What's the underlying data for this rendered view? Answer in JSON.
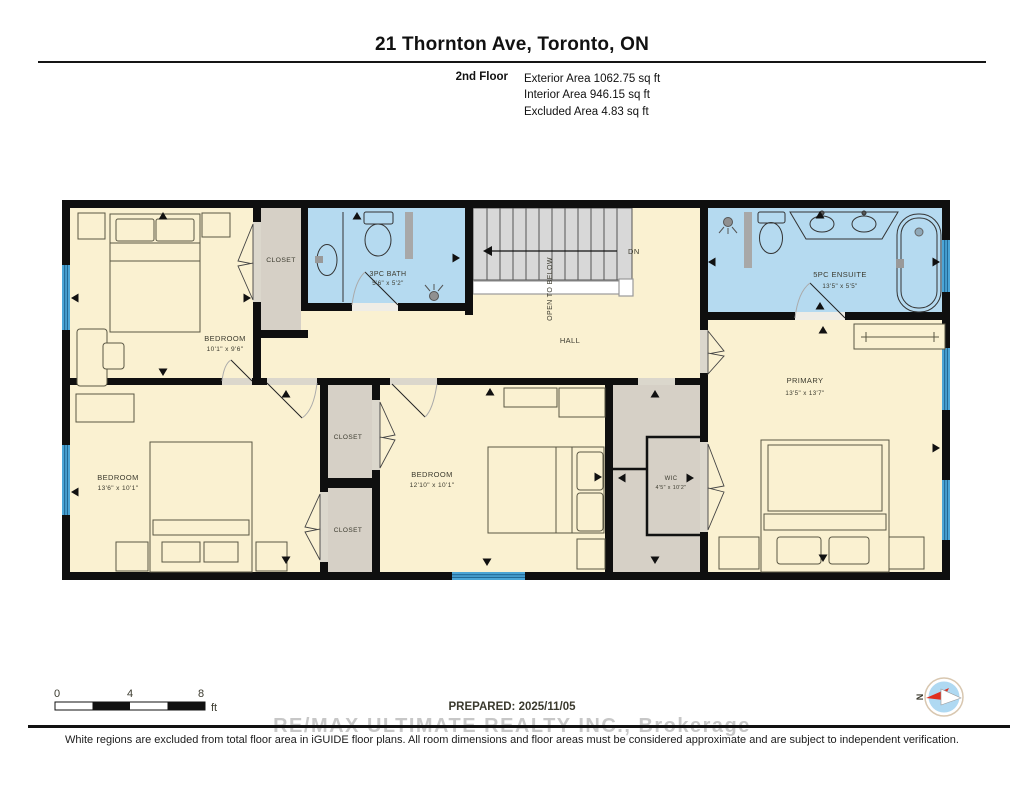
{
  "header": {
    "title": "21 Thornton Ave, Toronto, ON",
    "floor_label": "2nd Floor",
    "area_lines": [
      "Exterior Area 1062.75 sq ft",
      "Interior Area 946.15 sq ft",
      "Excluded Area 4.83 sq ft"
    ]
  },
  "plan": {
    "rooms": {
      "bedroom_nw": {
        "name": "BEDROOM",
        "dims": "10'1\" x 9'6\""
      },
      "closet_top": {
        "name": "CLOSET"
      },
      "bath": {
        "name": "3PC BATH",
        "dims": "5'6\" x 5'2\""
      },
      "hall": {
        "name": "HALL"
      },
      "ensuite": {
        "name": "5PC ENSUITE",
        "dims": "13'5\" x 5'5\""
      },
      "primary": {
        "name": "PRIMARY",
        "dims": "13'5\" x 13'7\""
      },
      "bedroom_sw": {
        "name": "BEDROOM",
        "dims": "13'6\" x 10'1\""
      },
      "bedroom_s": {
        "name": "BEDROOM",
        "dims": "12'10\" x 10'1\""
      },
      "closet_upper": {
        "name": "CLOSET"
      },
      "closet_lower": {
        "name": "CLOSET"
      },
      "wic": {
        "name": "WIC",
        "dims": "4'5\" x 10'2\""
      }
    },
    "stairs": {
      "down_label": "DN",
      "open_label": "OPEN TO BELOW"
    }
  },
  "footer": {
    "scale": {
      "tick0": "0",
      "tick4": "4",
      "tick8": "8",
      "unit": "ft"
    },
    "prepared": "PREPARED: 2025/11/05",
    "compass_north": "N",
    "watermark": "RE/MAX ULTIMATE REALTY INC., Brokerage",
    "disclaimer": "White regions are excluded from total floor area in iGUIDE floor plans. All room dimensions and floor areas must be considered approximate and are subject to independent verification."
  },
  "colors": {
    "floor_cream": "#FAF1D1",
    "bath_blue": "#B5DAF0",
    "closet_gray": "#D6D0C6",
    "stairs_gray": "#D8D8D8",
    "wall_black": "#0F0F0F",
    "window_blue": "#4BA5D6",
    "watermark_gray": "#C7C7C7"
  }
}
